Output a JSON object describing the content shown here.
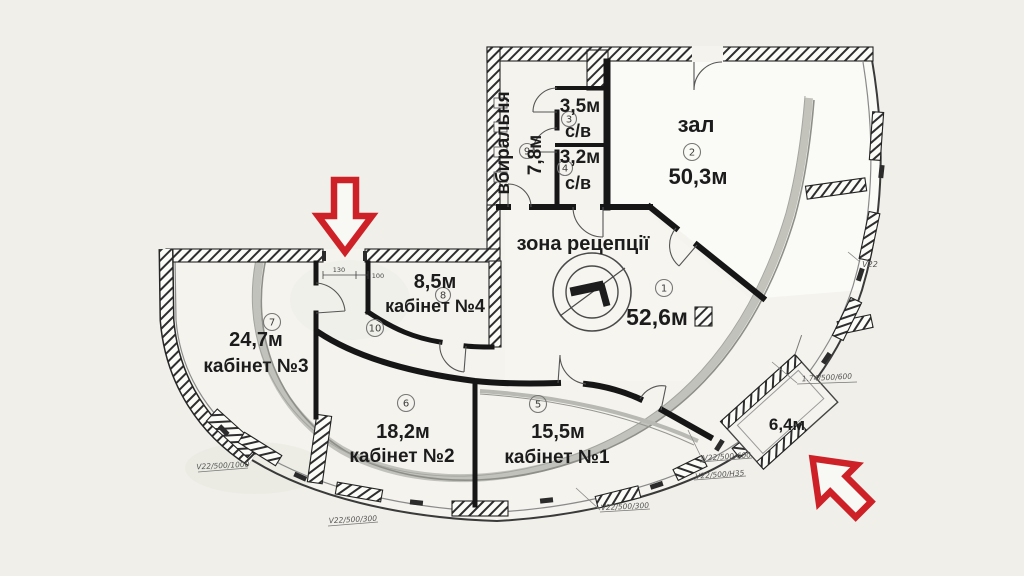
{
  "plan": {
    "title": "floor-plan",
    "rooms": {
      "reception": {
        "name": "зона рецепції",
        "area": "52,6м",
        "num": "1"
      },
      "hall": {
        "name": "зал",
        "area": "50,3м",
        "num": "2"
      },
      "wc1": {
        "name": "с/в",
        "area": "3,5м",
        "num": "3"
      },
      "wc2": {
        "name": "с/в",
        "area": "3,2м",
        "num": "4"
      },
      "office1": {
        "name": "кабінет №1",
        "area": "15,5м",
        "num": "5"
      },
      "office2": {
        "name": "кабінет №2",
        "area": "18,2м",
        "num": "6"
      },
      "office3": {
        "name": "кабінет №3",
        "area": "24,7м",
        "num": "7"
      },
      "office4": {
        "name": "кабінет №4",
        "area": "8,5м",
        "num": "8"
      },
      "restroom": {
        "name": "вбиральня",
        "area": "7,8м",
        "num": "9"
      },
      "corridor": {
        "num": "10"
      },
      "balcony": {
        "area": "6,4м"
      }
    },
    "annotations": {
      "v22": "V22",
      "a1": "1.74/500/600",
      "a2": "V22/500/600",
      "a3": "V22/500/H35",
      "a4": "V22/500/300",
      "a5": "V22/500/1000",
      "a6": "V22/500/300",
      "dim1": "130",
      "dim2": "100"
    },
    "colors": {
      "arrow": "#cd2127",
      "paper": "#f4f3ee",
      "wall": "#161616"
    }
  }
}
